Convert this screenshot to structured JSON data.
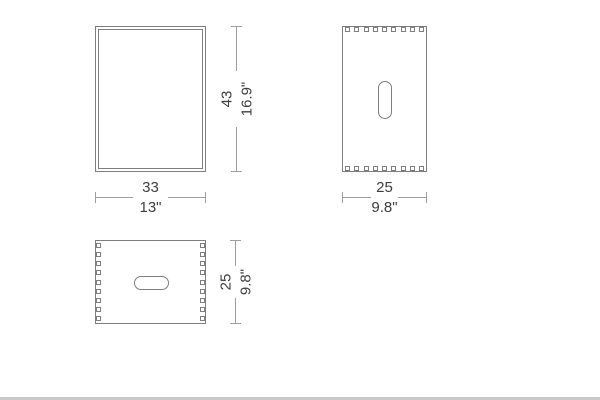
{
  "page": {
    "background": "#ffffff",
    "footer_strip_color": "#c9c9c9"
  },
  "drawing_style": {
    "shape_line_color": "#7e7e7e",
    "dimension_line_color": "#9e9e9e",
    "text_color": "#3d3d3d"
  },
  "dimensions": {
    "front_width": {
      "metric": "33",
      "imperial": "13\""
    },
    "front_height": {
      "metric": "43",
      "imperial": "16.9\""
    },
    "side_width": {
      "metric": "25",
      "imperial": "9.8\""
    },
    "top_depth": {
      "metric": "25",
      "imperial": "9.8\""
    }
  }
}
